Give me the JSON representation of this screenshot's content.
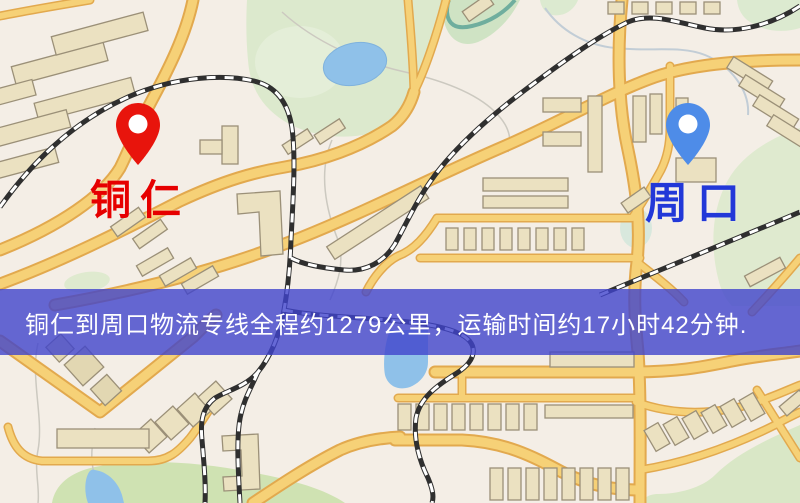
{
  "map": {
    "markers": [
      {
        "id": "tongren",
        "label": "铜仁",
        "pin_color": "#e8140c",
        "label_color": "#e60000"
      },
      {
        "id": "zhoukou",
        "label": "周口",
        "pin_color": "#4e8ce8",
        "label_color": "#2238d8"
      }
    ],
    "banner": {
      "text": "铜仁到周口物流专线全程约1279公里，运输时间约17小时42分钟.",
      "bg_color": "#4044cc",
      "text_color": "#ffffff"
    },
    "palette": {
      "background": "#f4eee6",
      "road_fill": "#f6d177",
      "road_casing": "#e2a94e",
      "railway": "#2f2f2f",
      "water": "#8fc1e9",
      "park": "#dce9cd",
      "park_dark": "#cfe2b2",
      "building_fill": "#ebe1c1",
      "building_stroke": "#9b9078"
    }
  }
}
